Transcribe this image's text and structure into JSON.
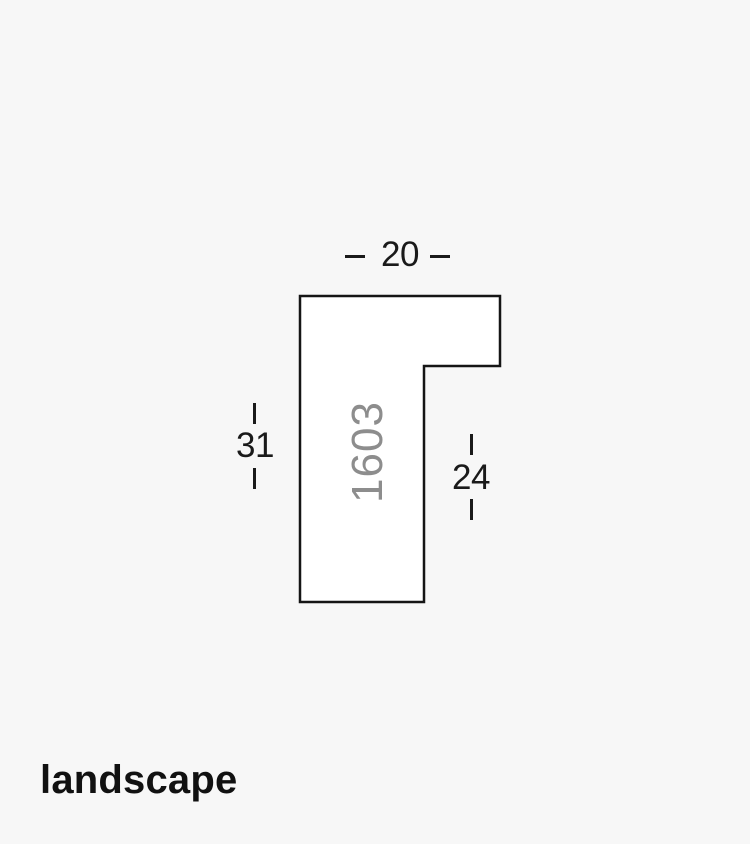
{
  "canvas": {
    "background_color": "#f7f7f7",
    "width": 750,
    "height": 844
  },
  "profile": {
    "code": "1603",
    "code_color": "#8d8d8d",
    "outline_color": "#151515",
    "fill_color": "#ffffff",
    "dimensions": {
      "top": {
        "value": "20",
        "position": "top-width"
      },
      "left": {
        "value": "31",
        "position": "left-overall-height"
      },
      "right": {
        "value": "24",
        "position": "right-rebate-height"
      }
    }
  },
  "caption": {
    "orientation": "landscape"
  }
}
